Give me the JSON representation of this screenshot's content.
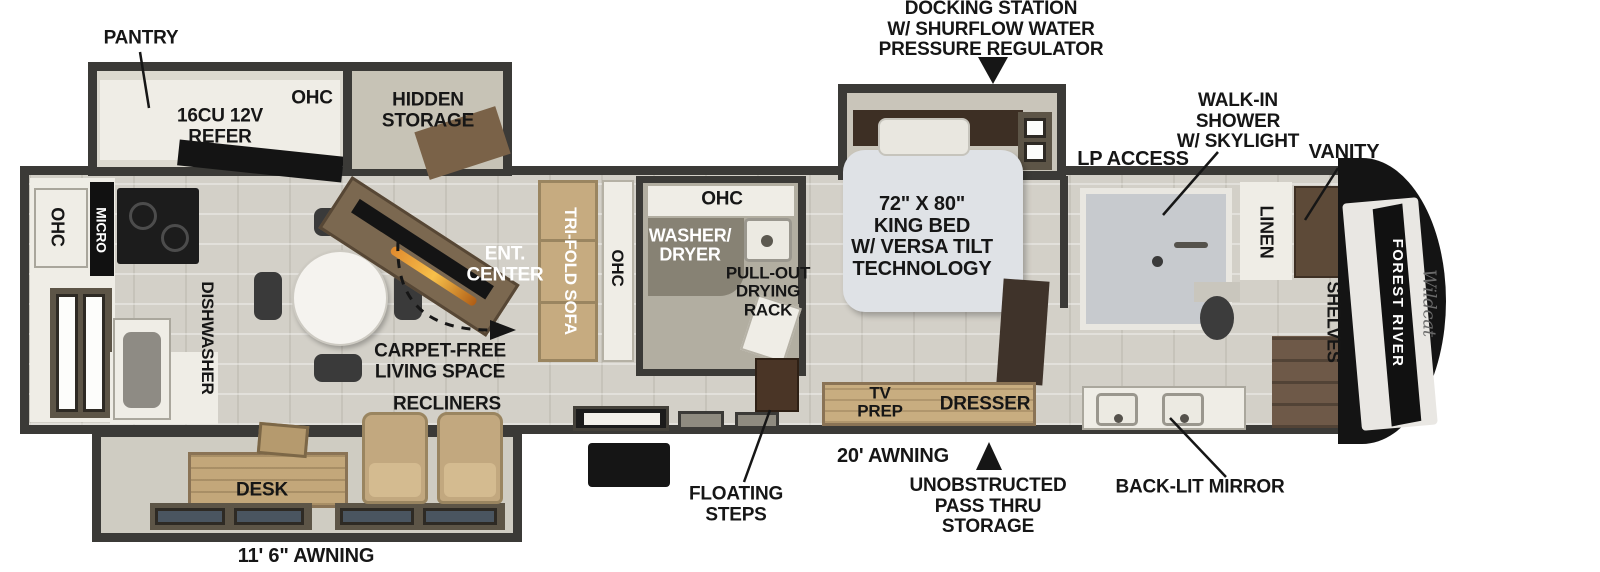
{
  "title": "Fifth wheel RV floorplan diagram",
  "brand": {
    "manufacturer": "FOREST RIVER",
    "model_script": "Wildcat"
  },
  "labels": {
    "docking_station": "DOCKING STATION\nW/ SHURFLOW WATER\nPRESSURE REGULATOR",
    "pantry": "PANTRY",
    "refer": "16CU 12V\nREFER",
    "ohc_kitchen": "OHC",
    "hidden_storage": "HIDDEN\nSTORAGE",
    "ohc_rear": "OHC",
    "micro": "MICRO",
    "dishwasher": "DISHWASHER",
    "ent_center": "ENT.\nCENTER",
    "carpet_free": "CARPET-FREE\nLIVING SPACE",
    "recliners": "RECLINERS",
    "desk": "DESK",
    "awning_rear": "11' 6\" AWNING",
    "tri_fold_sofa": "TRI-FOLD SOFA",
    "ohc_sofa": "OHC",
    "ohc_laundry": "OHC",
    "washer_dryer": "WASHER/\nDRYER",
    "drying_rack": "PULL-OUT\nDRYING\nRACK",
    "floating_steps": "FLOATING\nSTEPS",
    "king_bed": "72\" X 80\"\nKING BED\nW/ VERSA TILT\nTECHNOLOGY",
    "tv_prep": "TV\nPREP",
    "dresser": "DRESSER",
    "awning_main": "20' AWNING",
    "pass_thru": "UNOBSTRUCTED\nPASS THRU\nSTORAGE",
    "lp_access": "LP ACCESS",
    "walk_in_shower": "WALK-IN\nSHOWER\nW/ SKYLIGHT",
    "vanity": "VANITY",
    "linen": "LINEN",
    "shelves": "SHELVES",
    "back_lit_mirror": "BACK-LIT MIRROR"
  },
  "colors": {
    "wall": "#3b3a37",
    "floor_tile": "#d3d0c8",
    "counter_white": "#efede6",
    "beige_interior": "#cfccc2",
    "wood_light": "#c3a77a",
    "wood_dark": "#5d4a38",
    "sofa_tan": "#c6ab80",
    "bed_gray": "#dfe2e6",
    "appliance_black": "#151515",
    "label_black": "#161616",
    "label_white": "#ffffff"
  }
}
